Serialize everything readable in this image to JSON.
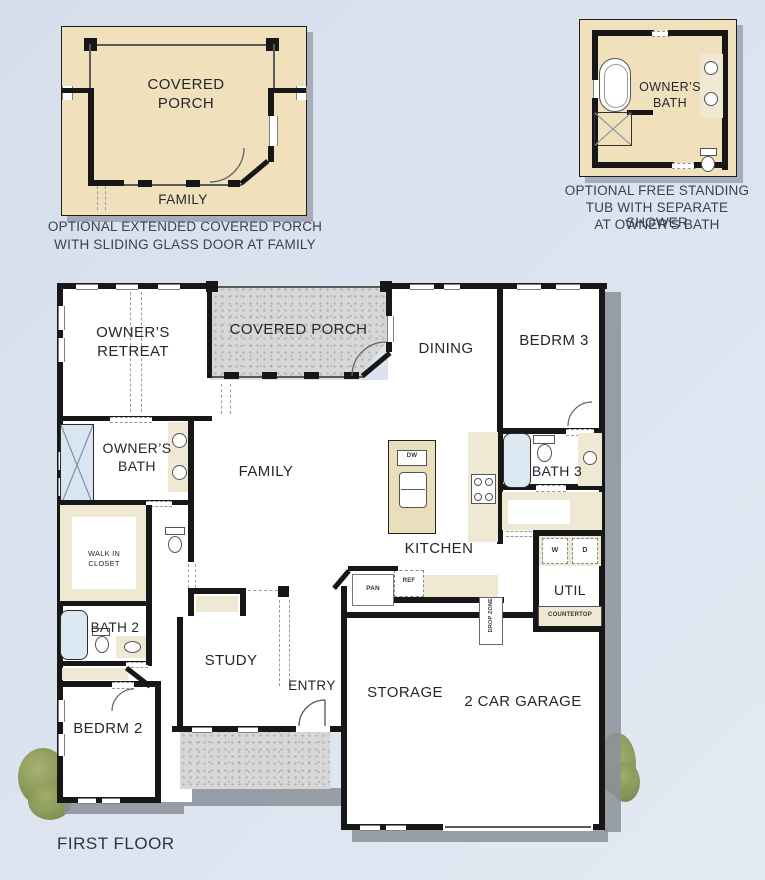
{
  "colors": {
    "background": "#dbe2ee",
    "wall": "#171717",
    "plan_floor": "#ffffff",
    "porch_concrete": "#d7d7d7",
    "inset_background": "#f0e1bc",
    "cabinet_cream": "#efe8d2",
    "island_tan": "#eadfbc",
    "fixture_blue": "#dce8f2",
    "shadow_gray": "#8b9099",
    "shrub_green": "#8e9c5c",
    "label_text": "#23272e",
    "caption_text": "#3a414f"
  },
  "inset_porch": {
    "room": "COVERED PORCH",
    "family_label": "FAMILY",
    "caption_line1": "OPTIONAL EXTENDED COVERED PORCH",
    "caption_line2": "WITH SLIDING GLASS DOOR AT FAMILY"
  },
  "inset_bath": {
    "room": "OWNER’S BATH",
    "caption_line1": "OPTIONAL FREE STANDING",
    "caption_line2": "TUB WITH SEPARATE SHOWER",
    "caption_line3": "AT OWNER’S BATH"
  },
  "plan": {
    "rooms": {
      "owners_retreat": "OWNER’S RETREAT",
      "covered_porch": "COVERED PORCH",
      "dining": "DINING",
      "bedrm3": "BEDRM 3",
      "owners_bath": "OWNER’S BATH",
      "family": "FAMILY",
      "kitchen": "KITCHEN",
      "bath3": "BATH 3",
      "walk_in_closet": "WALK IN CLOSET",
      "util": "UTIL",
      "bath2": "BATH 2",
      "study": "STUDY",
      "entry": "ENTRY",
      "bedrm2": "BEDRM 2",
      "storage": "STORAGE",
      "garage": "2 CAR GARAGE"
    },
    "fixtures": {
      "dw": "DW",
      "ref": "REF",
      "pan": "PAN",
      "drop_zone": "DROP ZONE",
      "washer": "W",
      "dryer": "D",
      "countertop": "COUNTERTOP"
    }
  },
  "footer": {
    "title": "FIRST FLOOR"
  }
}
